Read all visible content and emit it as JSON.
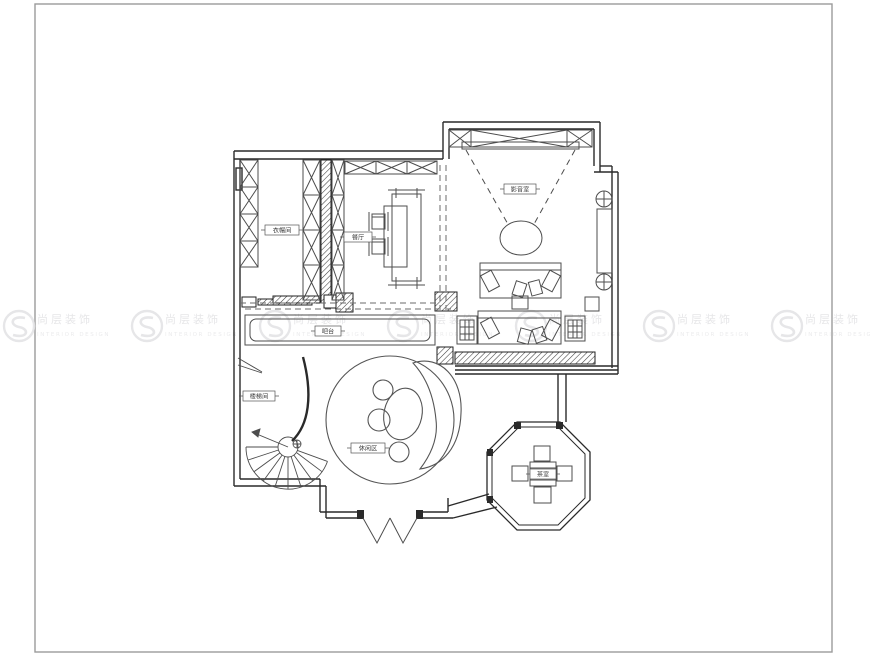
{
  "page": {
    "background_color": "#ffffff",
    "frame_color": "#9b9b9b"
  },
  "watermark": {
    "brand_cn": "尚层装饰",
    "brand_en": "INTERIOR DESIGN",
    "color": "#e4e4e6",
    "count": 7
  },
  "plan": {
    "line_color": "#4d4d4d",
    "wall_color": "#2a2a2a",
    "labels": {
      "cloakroom": "衣帽间",
      "dining_room": "餐厅",
      "media_room": "影音室",
      "bar_counter": "吧台",
      "lounge_feature": "休闲区",
      "staircase": "楼梯间",
      "tea_room": "茶室"
    }
  }
}
